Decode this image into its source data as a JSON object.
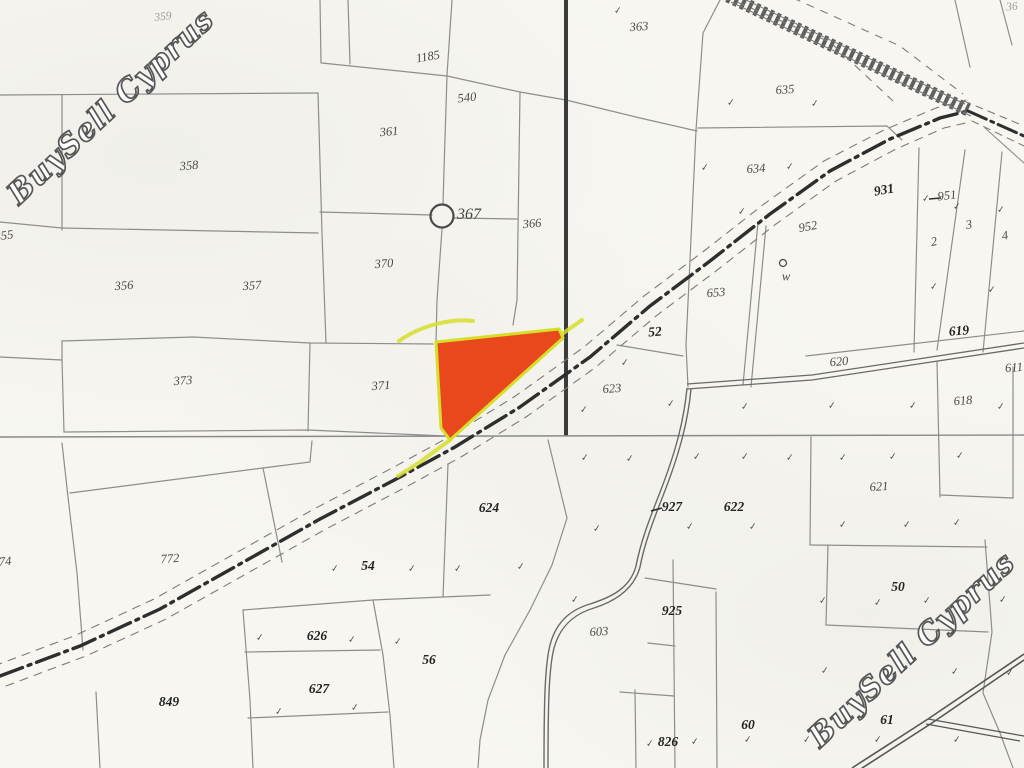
{
  "map": {
    "watermarks": [
      {
        "text": "BuySell Cyprus"
      },
      {
        "text": "BuySell Cyprus"
      }
    ],
    "highlight": {
      "fill": "#e8481c",
      "outline": "#d6de2a"
    },
    "circled_parcel": "367",
    "well_label": "w",
    "labels": [
      {
        "t": "359",
        "x": 163,
        "y": 17,
        "c": "faint",
        "r": -6
      },
      {
        "t": "1185",
        "x": 428,
        "y": 57,
        "c": "n",
        "r": -10
      },
      {
        "t": "363",
        "x": 639,
        "y": 27,
        "c": "n",
        "r": -4
      },
      {
        "t": "540",
        "x": 467,
        "y": 98,
        "c": "n",
        "r": -6
      },
      {
        "t": "635",
        "x": 785,
        "y": 90,
        "c": "n",
        "r": -4
      },
      {
        "t": "361",
        "x": 389,
        "y": 132,
        "c": "n",
        "r": -5
      },
      {
        "t": "358",
        "x": 189,
        "y": 166,
        "c": "n",
        "r": -5
      },
      {
        "t": "634",
        "x": 756,
        "y": 169,
        "c": "n",
        "r": -4
      },
      {
        "t": "951",
        "x": 947,
        "y": 196,
        "c": "n",
        "r": -6
      },
      {
        "t": "952",
        "x": 808,
        "y": 227,
        "c": "n",
        "r": -10
      },
      {
        "t": "931",
        "x": 884,
        "y": 190,
        "c": "b",
        "r": -10
      },
      {
        "t": "355",
        "x": 4,
        "y": 236,
        "c": "n",
        "r": -8
      },
      {
        "t": "367",
        "x": 469,
        "y": 215,
        "c": "n367",
        "r": 0
      },
      {
        "t": "366",
        "x": 532,
        "y": 224,
        "c": "n",
        "r": -5
      },
      {
        "t": "370",
        "x": 384,
        "y": 264,
        "c": "n",
        "r": -4
      },
      {
        "t": "356",
        "x": 124,
        "y": 286,
        "c": "n",
        "r": -4
      },
      {
        "t": "357",
        "x": 252,
        "y": 286,
        "c": "n",
        "r": -4
      },
      {
        "t": "653",
        "x": 716,
        "y": 293,
        "c": "n",
        "r": -5
      },
      {
        "t": "w",
        "x": 786,
        "y": 277,
        "c": "n",
        "r": 0
      },
      {
        "t": "52",
        "x": 655,
        "y": 332,
        "c": "b",
        "r": -4
      },
      {
        "t": "2",
        "x": 934,
        "y": 242,
        "c": "n",
        "r": -10
      },
      {
        "t": "3",
        "x": 969,
        "y": 225,
        "c": "n",
        "r": -10
      },
      {
        "t": "4",
        "x": 1005,
        "y": 236,
        "c": "n",
        "r": -10
      },
      {
        "t": "619",
        "x": 959,
        "y": 331,
        "c": "b",
        "r": -5
      },
      {
        "t": "623",
        "x": 612,
        "y": 389,
        "c": "n",
        "r": -4
      },
      {
        "t": "373",
        "x": 183,
        "y": 381,
        "c": "n",
        "r": -4
      },
      {
        "t": "371",
        "x": 381,
        "y": 386,
        "c": "n",
        "r": -4
      },
      {
        "t": "620",
        "x": 839,
        "y": 362,
        "c": "n",
        "r": -5
      },
      {
        "t": "618",
        "x": 963,
        "y": 401,
        "c": "n",
        "r": -5
      },
      {
        "t": "611",
        "x": 1014,
        "y": 368,
        "c": "n",
        "r": -5
      },
      {
        "t": "36",
        "x": 1012,
        "y": 7,
        "c": "faint",
        "r": -5
      },
      {
        "t": "621",
        "x": 879,
        "y": 487,
        "c": "n",
        "r": -4
      },
      {
        "t": "624",
        "x": 489,
        "y": 508,
        "c": "b",
        "r": 0
      },
      {
        "t": "927",
        "x": 672,
        "y": 507,
        "c": "b",
        "r": 0
      },
      {
        "t": "622",
        "x": 734,
        "y": 507,
        "c": "b",
        "r": 0
      },
      {
        "t": "54",
        "x": 368,
        "y": 566,
        "c": "b",
        "r": 0
      },
      {
        "t": "772",
        "x": 170,
        "y": 559,
        "c": "n",
        "r": -4
      },
      {
        "t": "774",
        "x": 2,
        "y": 562,
        "c": "n",
        "r": -4
      },
      {
        "t": "50",
        "x": 898,
        "y": 587,
        "c": "b",
        "r": 0
      },
      {
        "t": "626",
        "x": 317,
        "y": 636,
        "c": "b",
        "r": 0
      },
      {
        "t": "56",
        "x": 429,
        "y": 660,
        "c": "b",
        "r": 0
      },
      {
        "t": "627",
        "x": 319,
        "y": 689,
        "c": "b",
        "r": 0
      },
      {
        "t": "849",
        "x": 169,
        "y": 702,
        "c": "b",
        "r": 0
      },
      {
        "t": "603",
        "x": 599,
        "y": 632,
        "c": "n",
        "r": -4
      },
      {
        "t": "925",
        "x": 672,
        "y": 611,
        "c": "b",
        "r": 0
      },
      {
        "t": "826",
        "x": 668,
        "y": 742,
        "c": "b",
        "r": 0
      },
      {
        "t": "60",
        "x": 748,
        "y": 725,
        "c": "b",
        "r": 0
      },
      {
        "t": "61",
        "x": 887,
        "y": 720,
        "c": "b",
        "r": 0
      }
    ],
    "veg_marks": [
      [
        618,
        11
      ],
      [
        731,
        103
      ],
      [
        815,
        104
      ],
      [
        705,
        168
      ],
      [
        790,
        167
      ],
      [
        742,
        212
      ],
      [
        926,
        199
      ],
      [
        957,
        207
      ],
      [
        1001,
        210
      ],
      [
        934,
        287
      ],
      [
        992,
        290
      ],
      [
        625,
        363
      ],
      [
        584,
        410
      ],
      [
        671,
        404
      ],
      [
        745,
        407
      ],
      [
        832,
        406
      ],
      [
        913,
        406
      ],
      [
        1001,
        407
      ],
      [
        585,
        458
      ],
      [
        630,
        459
      ],
      [
        697,
        457
      ],
      [
        745,
        457
      ],
      [
        790,
        458
      ],
      [
        843,
        458
      ],
      [
        893,
        457
      ],
      [
        960,
        456
      ],
      [
        597,
        529
      ],
      [
        690,
        527
      ],
      [
        753,
        527
      ],
      [
        843,
        525
      ],
      [
        907,
        525
      ],
      [
        957,
        523
      ],
      [
        823,
        601
      ],
      [
        878,
        603
      ],
      [
        927,
        601
      ],
      [
        1003,
        600
      ],
      [
        825,
        671
      ],
      [
        955,
        672
      ],
      [
        1010,
        673
      ],
      [
        807,
        740
      ],
      [
        878,
        740
      ],
      [
        957,
        740
      ],
      [
        335,
        569
      ],
      [
        412,
        569
      ],
      [
        458,
        569
      ],
      [
        521,
        567
      ],
      [
        260,
        638
      ],
      [
        352,
        640
      ],
      [
        398,
        642
      ],
      [
        279,
        712
      ],
      [
        355,
        708
      ],
      [
        575,
        600
      ],
      [
        650,
        744
      ],
      [
        695,
        742
      ],
      [
        748,
        740
      ]
    ]
  }
}
